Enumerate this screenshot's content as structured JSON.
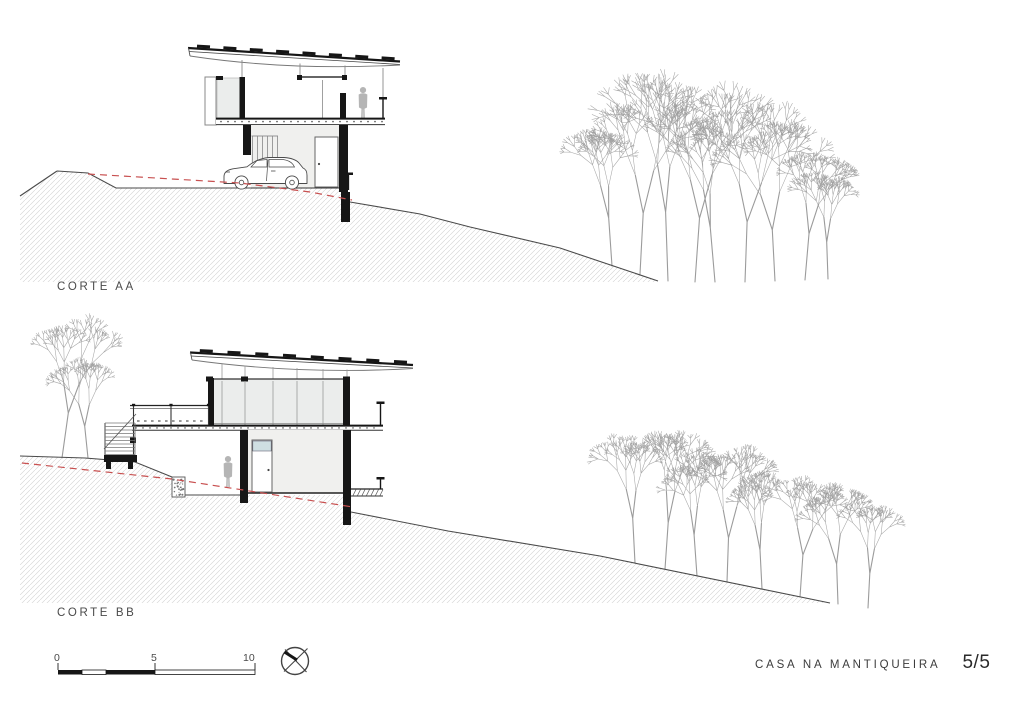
{
  "sheet": {
    "background": "#ffffff",
    "sections": [
      {
        "label": "CORTE AA"
      },
      {
        "label": "CORTE BB"
      }
    ],
    "title_block": {
      "project": "CASA NA MANTIQUEIRA",
      "sheet_number": "5/5"
    },
    "scale_bar": {
      "tick_labels": [
        "0",
        "5",
        "10"
      ],
      "unit_span": 10
    },
    "colors": {
      "terrain_line": "#4a4a4a",
      "original_terrain_dashed": "#c85050",
      "structure_black": "#161616",
      "tree_line": "#9b9b9b",
      "hatch_line": "#d2d2d2",
      "panel_fill": "#f0f0ee",
      "glass_fill": "#ebedec",
      "window_fill": "#cfdfe2",
      "figure_fill": "#b5b5b5"
    },
    "icons": [
      {
        "name": "north-compass-icon"
      }
    ]
  }
}
